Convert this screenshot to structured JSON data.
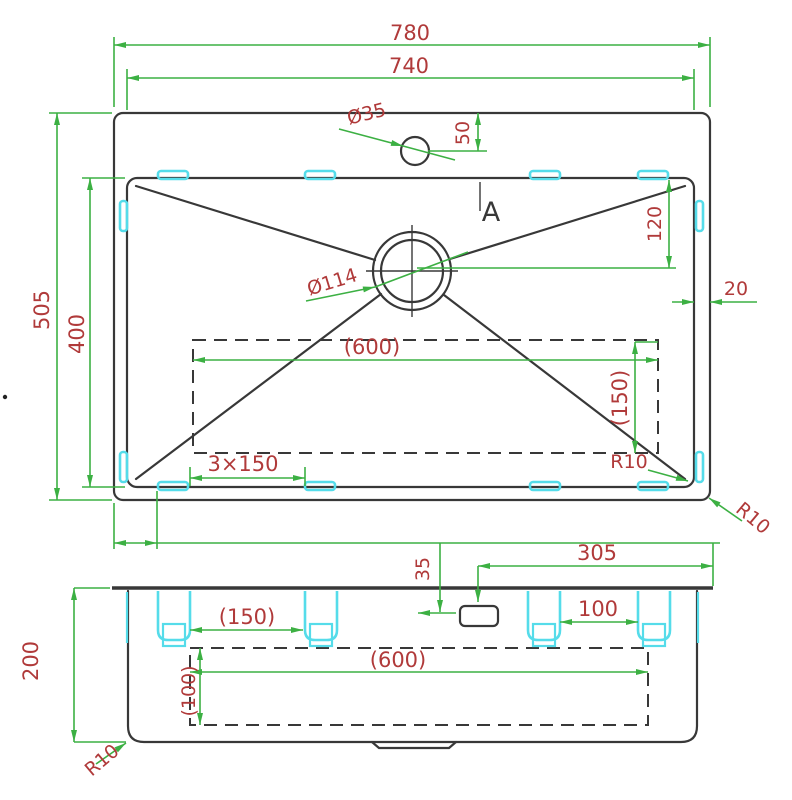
{
  "colors": {
    "bg": "#ffffff",
    "line": "#383838",
    "dim": "#3cb043",
    "text": "#b03a3a",
    "clip": "#55dcea"
  },
  "top_view": {
    "dims": {
      "overall_width": "780",
      "inner_width": "740",
      "faucet_hole_diameter": "Ø35",
      "faucet_hole_offset": "50",
      "overall_depth": "505",
      "bowl_depth": "400",
      "drain_offset_from_back": "120",
      "rim_width": "20",
      "drain_diameter": "Ø114",
      "cutout_width": "(600)",
      "cutout_depth": "(150)",
      "clip_pitch": "3×150",
      "bowl_corner_radius": "R10",
      "outer_corner_radius": "R10",
      "section_label": "A"
    }
  },
  "front_view": {
    "dims": {
      "drain_to_right_edge": "305",
      "faucet_center_drop": "35",
      "clip_gap_left": "(150)",
      "clip_gap_right": "100",
      "cutout_width": "(600)",
      "cutout_depth": "(100)",
      "bowl_height": "200",
      "corner_radius": "R10"
    }
  }
}
